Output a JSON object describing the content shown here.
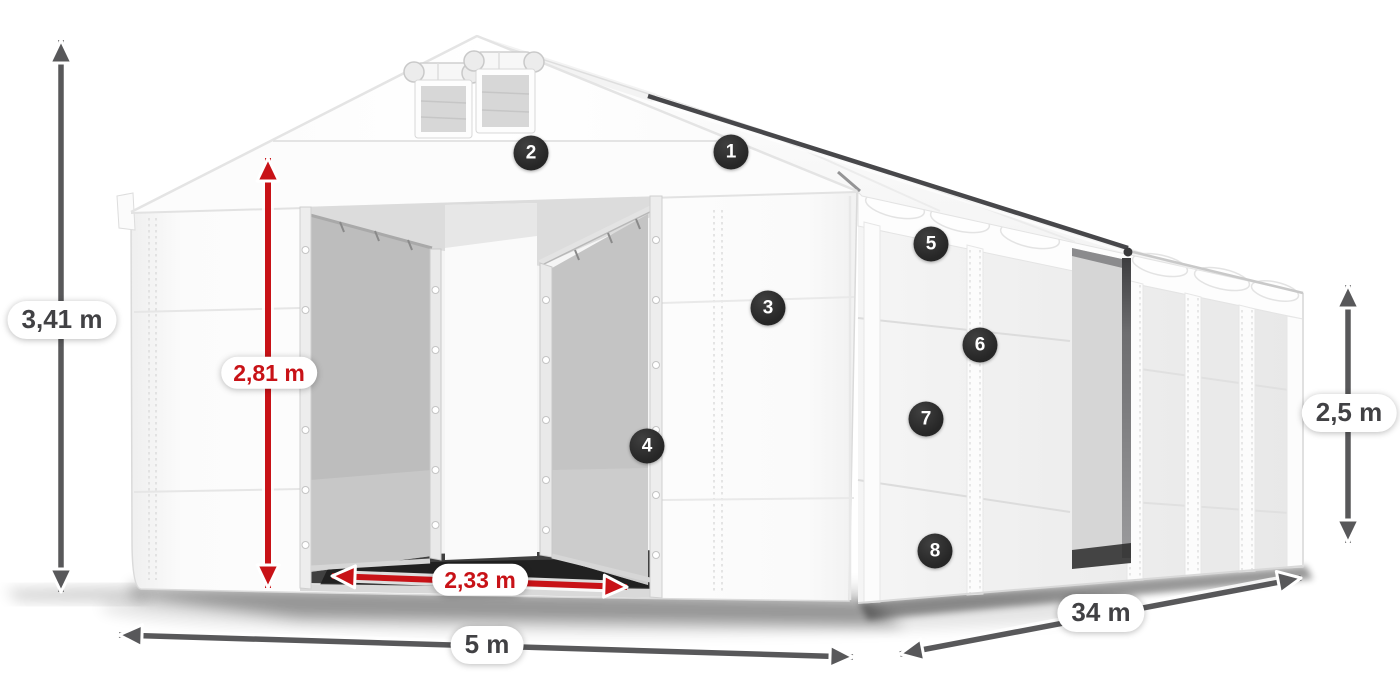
{
  "colors": {
    "background": "#ffffff",
    "dimension_gray": "#58585a",
    "dimension_red": "#c81217",
    "badge_background": "#262626",
    "badge_text": "#ffffff",
    "label_background": "#ffffff",
    "label_text": "#414144"
  },
  "dimensions": {
    "total_height": "3,41 m",
    "entrance_height": "2,81 m",
    "entrance_width": "2,33 m",
    "width": "5 m",
    "length": "34 m",
    "side_wall_height": "2,5 m"
  },
  "markers": [
    "1",
    "2",
    "3",
    "4",
    "5",
    "6",
    "7",
    "8"
  ]
}
